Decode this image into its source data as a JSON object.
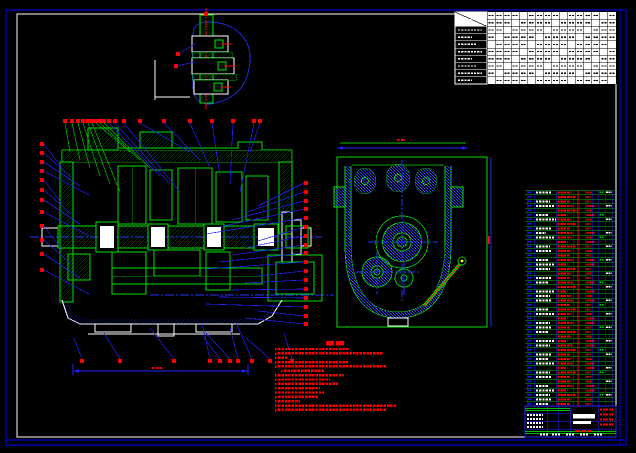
{
  "app": {
    "type": "cad-assembly-drawing",
    "background": "#000000",
    "legible_text": false
  },
  "palette": {
    "green": "#00e000",
    "dark_green": "#00a000",
    "blue": "#2222ff",
    "bright_blue": "#0000ff",
    "red": "#ff0000",
    "white": "#ffffff",
    "yellow": "#ffff00",
    "black": "#000000"
  },
  "frame": {
    "outer_color": "#0000ff",
    "inner_color": "#ffffff"
  },
  "param_table": {
    "rows": 10,
    "cols": 16,
    "label_col_rows": 8,
    "legible": false
  },
  "detail_view": {
    "balloons": [
      [
        204,
        12
      ],
      [
        176,
        52
      ],
      [
        174,
        64
      ]
    ]
  },
  "main_view": {
    "balloons_top_x": [
      63,
      70,
      76,
      81,
      86,
      90,
      94,
      98,
      102,
      107,
      113,
      122,
      138,
      162,
      188,
      210,
      231,
      252,
      258
    ],
    "balloons_top_y": 119,
    "balloons_left_x": 40,
    "balloons_left_y": [
      142,
      151,
      160,
      169,
      178,
      188,
      198,
      210,
      224,
      238,
      252,
      268
    ],
    "balloons_right_x": 304,
    "balloons_right_y": [
      181,
      190,
      199,
      207,
      216,
      225,
      234,
      243,
      251,
      260,
      269,
      278,
      287,
      296,
      305,
      314,
      322
    ],
    "balloons_bottom_x": [
      80,
      118,
      172,
      208,
      218,
      228,
      236,
      250,
      268,
      290
    ],
    "balloons_bottom_y": 359,
    "dimension": {
      "y": 371,
      "x1": 73,
      "x2": 248
    }
  },
  "side_view": {
    "top_dim_y": 148,
    "right_dim_x": 491,
    "has_dipstick": true
  },
  "notes": {
    "heading_glyphs": 4,
    "lines": [
      {
        "w": 72
      },
      {
        "w": 105
      },
      {
        "w": 9
      },
      {
        "w": 70
      },
      {
        "w": 108
      },
      {
        "w": 40,
        "i": 6
      },
      {
        "w": 66
      },
      {
        "w": 52
      },
      {
        "w": 60
      },
      {
        "w": 42
      },
      {
        "w": 46
      },
      {
        "w": 40
      },
      {
        "w": 22
      },
      {
        "w": 118
      },
      {
        "w": 108
      }
    ]
  },
  "bom": {
    "row_count": 48,
    "top_y": 190,
    "row_step": 4.5,
    "col_x": [
      527,
      534,
      556,
      573,
      585,
      592,
      598,
      605,
      612
    ],
    "red_divider_x": 578,
    "code_w": [
      16,
      0,
      14,
      18,
      0,
      12,
      20,
      0,
      16,
      10,
      18,
      0,
      14,
      16,
      0,
      12,
      18,
      14,
      0,
      16,
      12,
      0,
      18,
      14,
      16,
      0,
      12,
      18,
      0,
      14,
      16,
      12,
      0,
      18,
      14,
      0,
      16,
      12,
      18,
      0,
      14,
      16,
      0,
      12,
      18,
      14,
      16,
      12
    ],
    "name_w": [
      14,
      18,
      12,
      16,
      20,
      10,
      14,
      18,
      12,
      16,
      14,
      10,
      18,
      14,
      12,
      16,
      10,
      18,
      14,
      12,
      16,
      18,
      10,
      14,
      16,
      12,
      18,
      14,
      10,
      16,
      12,
      18,
      14,
      10,
      16,
      18,
      12,
      14,
      16,
      10,
      18,
      12,
      14,
      16,
      10,
      18,
      14,
      12
    ]
  },
  "title_block": {
    "red_lines_right": 4,
    "white_value_rows": 4,
    "legible": false
  }
}
